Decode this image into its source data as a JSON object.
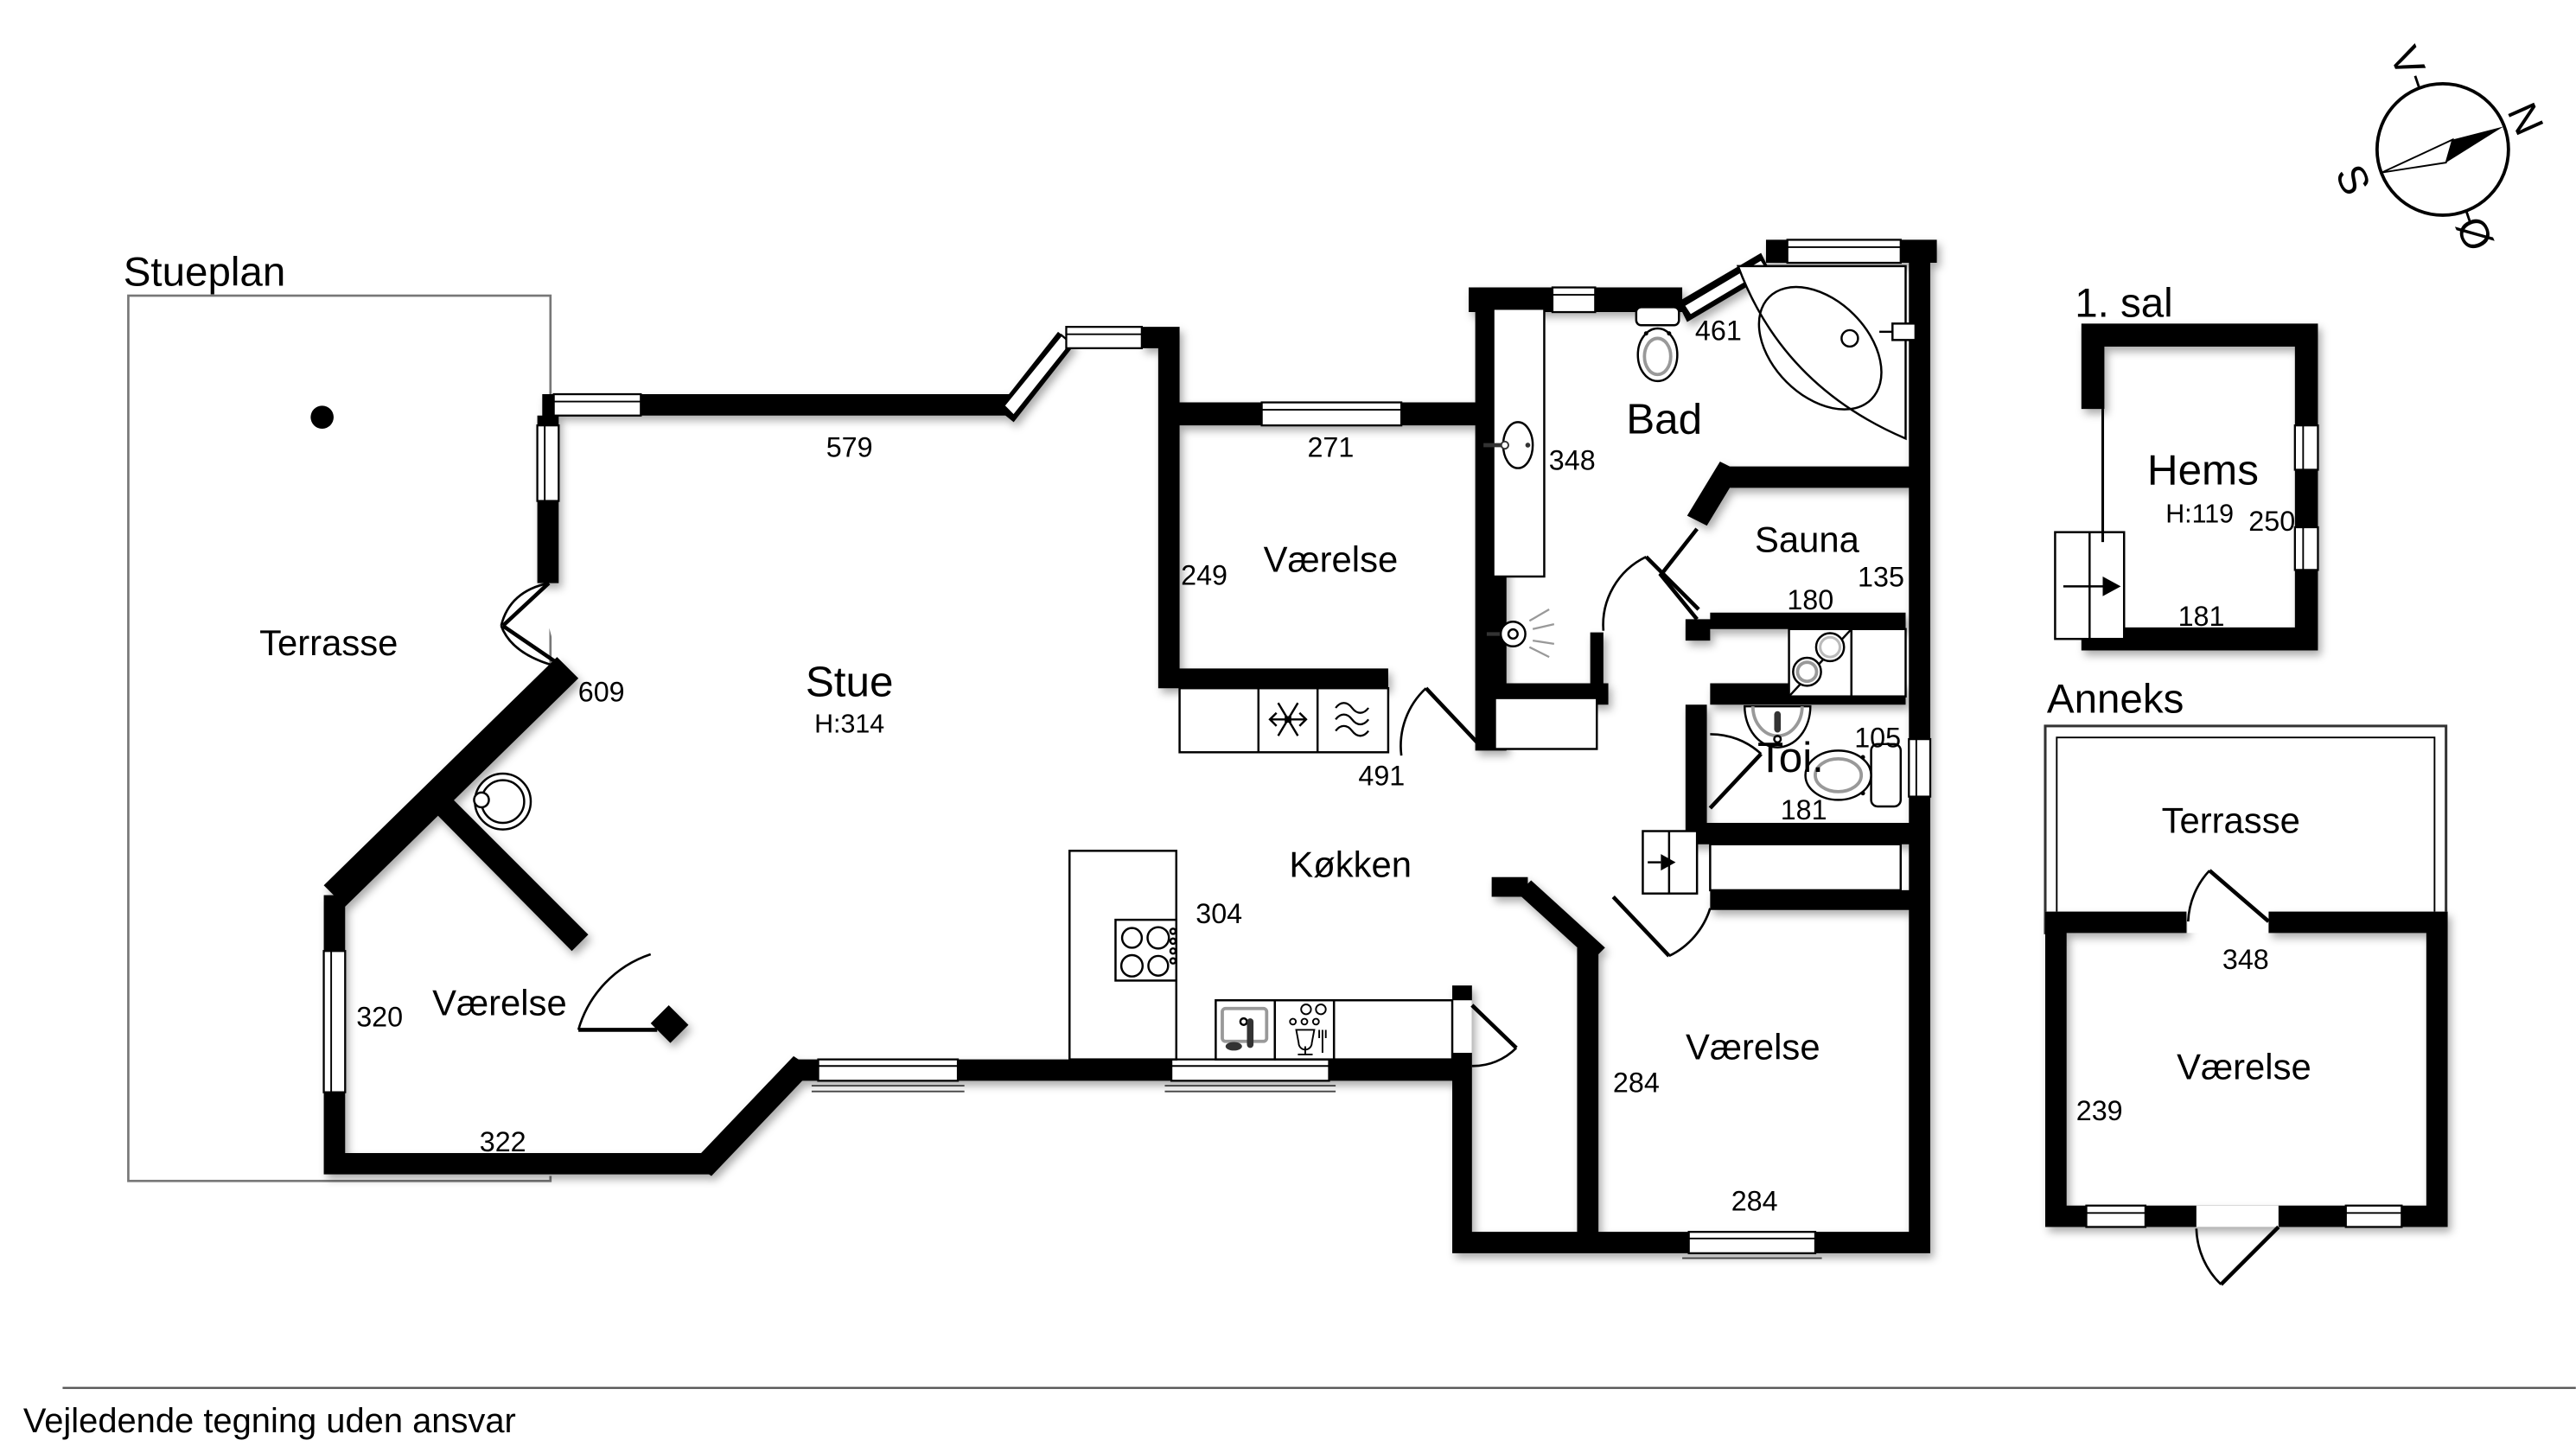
{
  "titles": {
    "main": "Stueplan",
    "first_floor": "1. sal",
    "annex": "Anneks"
  },
  "footer": {
    "disclaimer": "Vejledende tegning uden ansvar"
  },
  "compass": {
    "west": "V",
    "north": "N",
    "south": "S",
    "east": "Ø"
  },
  "main_floor": {
    "terrasse": {
      "label": "Terrasse"
    },
    "stue": {
      "label": "Stue",
      "ceiling": "H:314",
      "dim_top": "579",
      "dim_door": "609"
    },
    "vaerelse_mid": {
      "label": "Værelse",
      "dim_top": "271",
      "dim_left": "249",
      "dim_bottom": "491"
    },
    "bad": {
      "label": "Bad",
      "dim_top": "461",
      "dim_left": "348"
    },
    "sauna": {
      "label": "Sauna",
      "dim_right": "135",
      "dim_bottom": "180"
    },
    "toi": {
      "label": "Toi.",
      "dim_top": "105",
      "dim_bottom": "181"
    },
    "koekken": {
      "label": "Køkken",
      "dim": "304"
    },
    "vaerelse_sw": {
      "label": "Værelse",
      "dim_left": "320",
      "dim_bottom": "322"
    },
    "vaerelse_se": {
      "label": "Værelse",
      "dim_left": "284",
      "dim_bottom": "284"
    }
  },
  "first_floor": {
    "hems": {
      "label": "Hems",
      "ceiling": "H:119",
      "dim_right": "250",
      "dim_bottom": "181"
    }
  },
  "annex": {
    "terrasse": {
      "label": "Terrasse",
      "dim_bottom": "348"
    },
    "vaerelse": {
      "label": "Værelse",
      "dim_left": "239"
    }
  }
}
